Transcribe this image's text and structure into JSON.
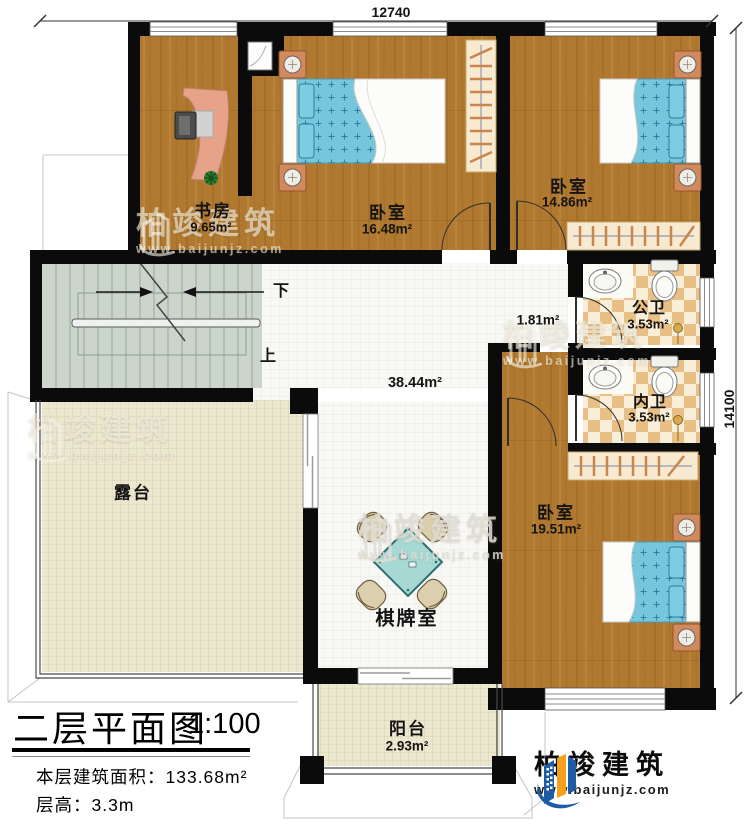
{
  "plan": {
    "dimension_top": "12740",
    "dimension_right": "14100",
    "rooms": {
      "study": {
        "name": "书房",
        "area": "9.65m²"
      },
      "bedroom_top": {
        "name": "卧室",
        "area": "16.48m²"
      },
      "bedroom_right": {
        "name": "卧室",
        "area": "14.86m²"
      },
      "bedroom_bottom": {
        "name": "卧室",
        "area": "19.51m²"
      },
      "public_bath": {
        "name": "公卫",
        "area": "3.53m²"
      },
      "ensuite_bath": {
        "name": "内卫",
        "area": "3.53m²"
      },
      "corridor": {
        "area": "1.81m²"
      },
      "game_room": {
        "name": "棋牌室",
        "area": "38.44m²"
      },
      "terrace": {
        "name": "露台"
      },
      "balcony": {
        "name": "阳台",
        "area": "2.93m²"
      }
    },
    "stairs": {
      "down": "下",
      "up": "上"
    }
  },
  "title_block": {
    "title": "二层平面图",
    "scale": "1:100",
    "floor_area_line": "本层建筑面积：133.68m²",
    "floor_height_line": "层高：3.3m"
  },
  "brand": {
    "name": "柏竣建筑",
    "url": "www.baijunjz.com"
  },
  "watermark": {
    "name": "柏竣建筑",
    "url": "www.baijunjz.com"
  },
  "icons": {
    "logo": "building-logo-icon",
    "watermark": "building-watermark-icon"
  },
  "colors": {
    "wall": "#0b0b0b",
    "wood_floor": "#b0792f",
    "hall_tile": "#f8f8f5",
    "terrace_tile": "#ece7cf",
    "stair": "#cbd5cb",
    "bathroom_tan": "#e8bf84",
    "bed_blue": "#76c7db",
    "nightstand": "#d28a5c",
    "desk": "#e7a28a",
    "table_teal": "#a6d9d4",
    "logo_blue": "#1d5ba5",
    "logo_orange": "#f5a01c"
  }
}
